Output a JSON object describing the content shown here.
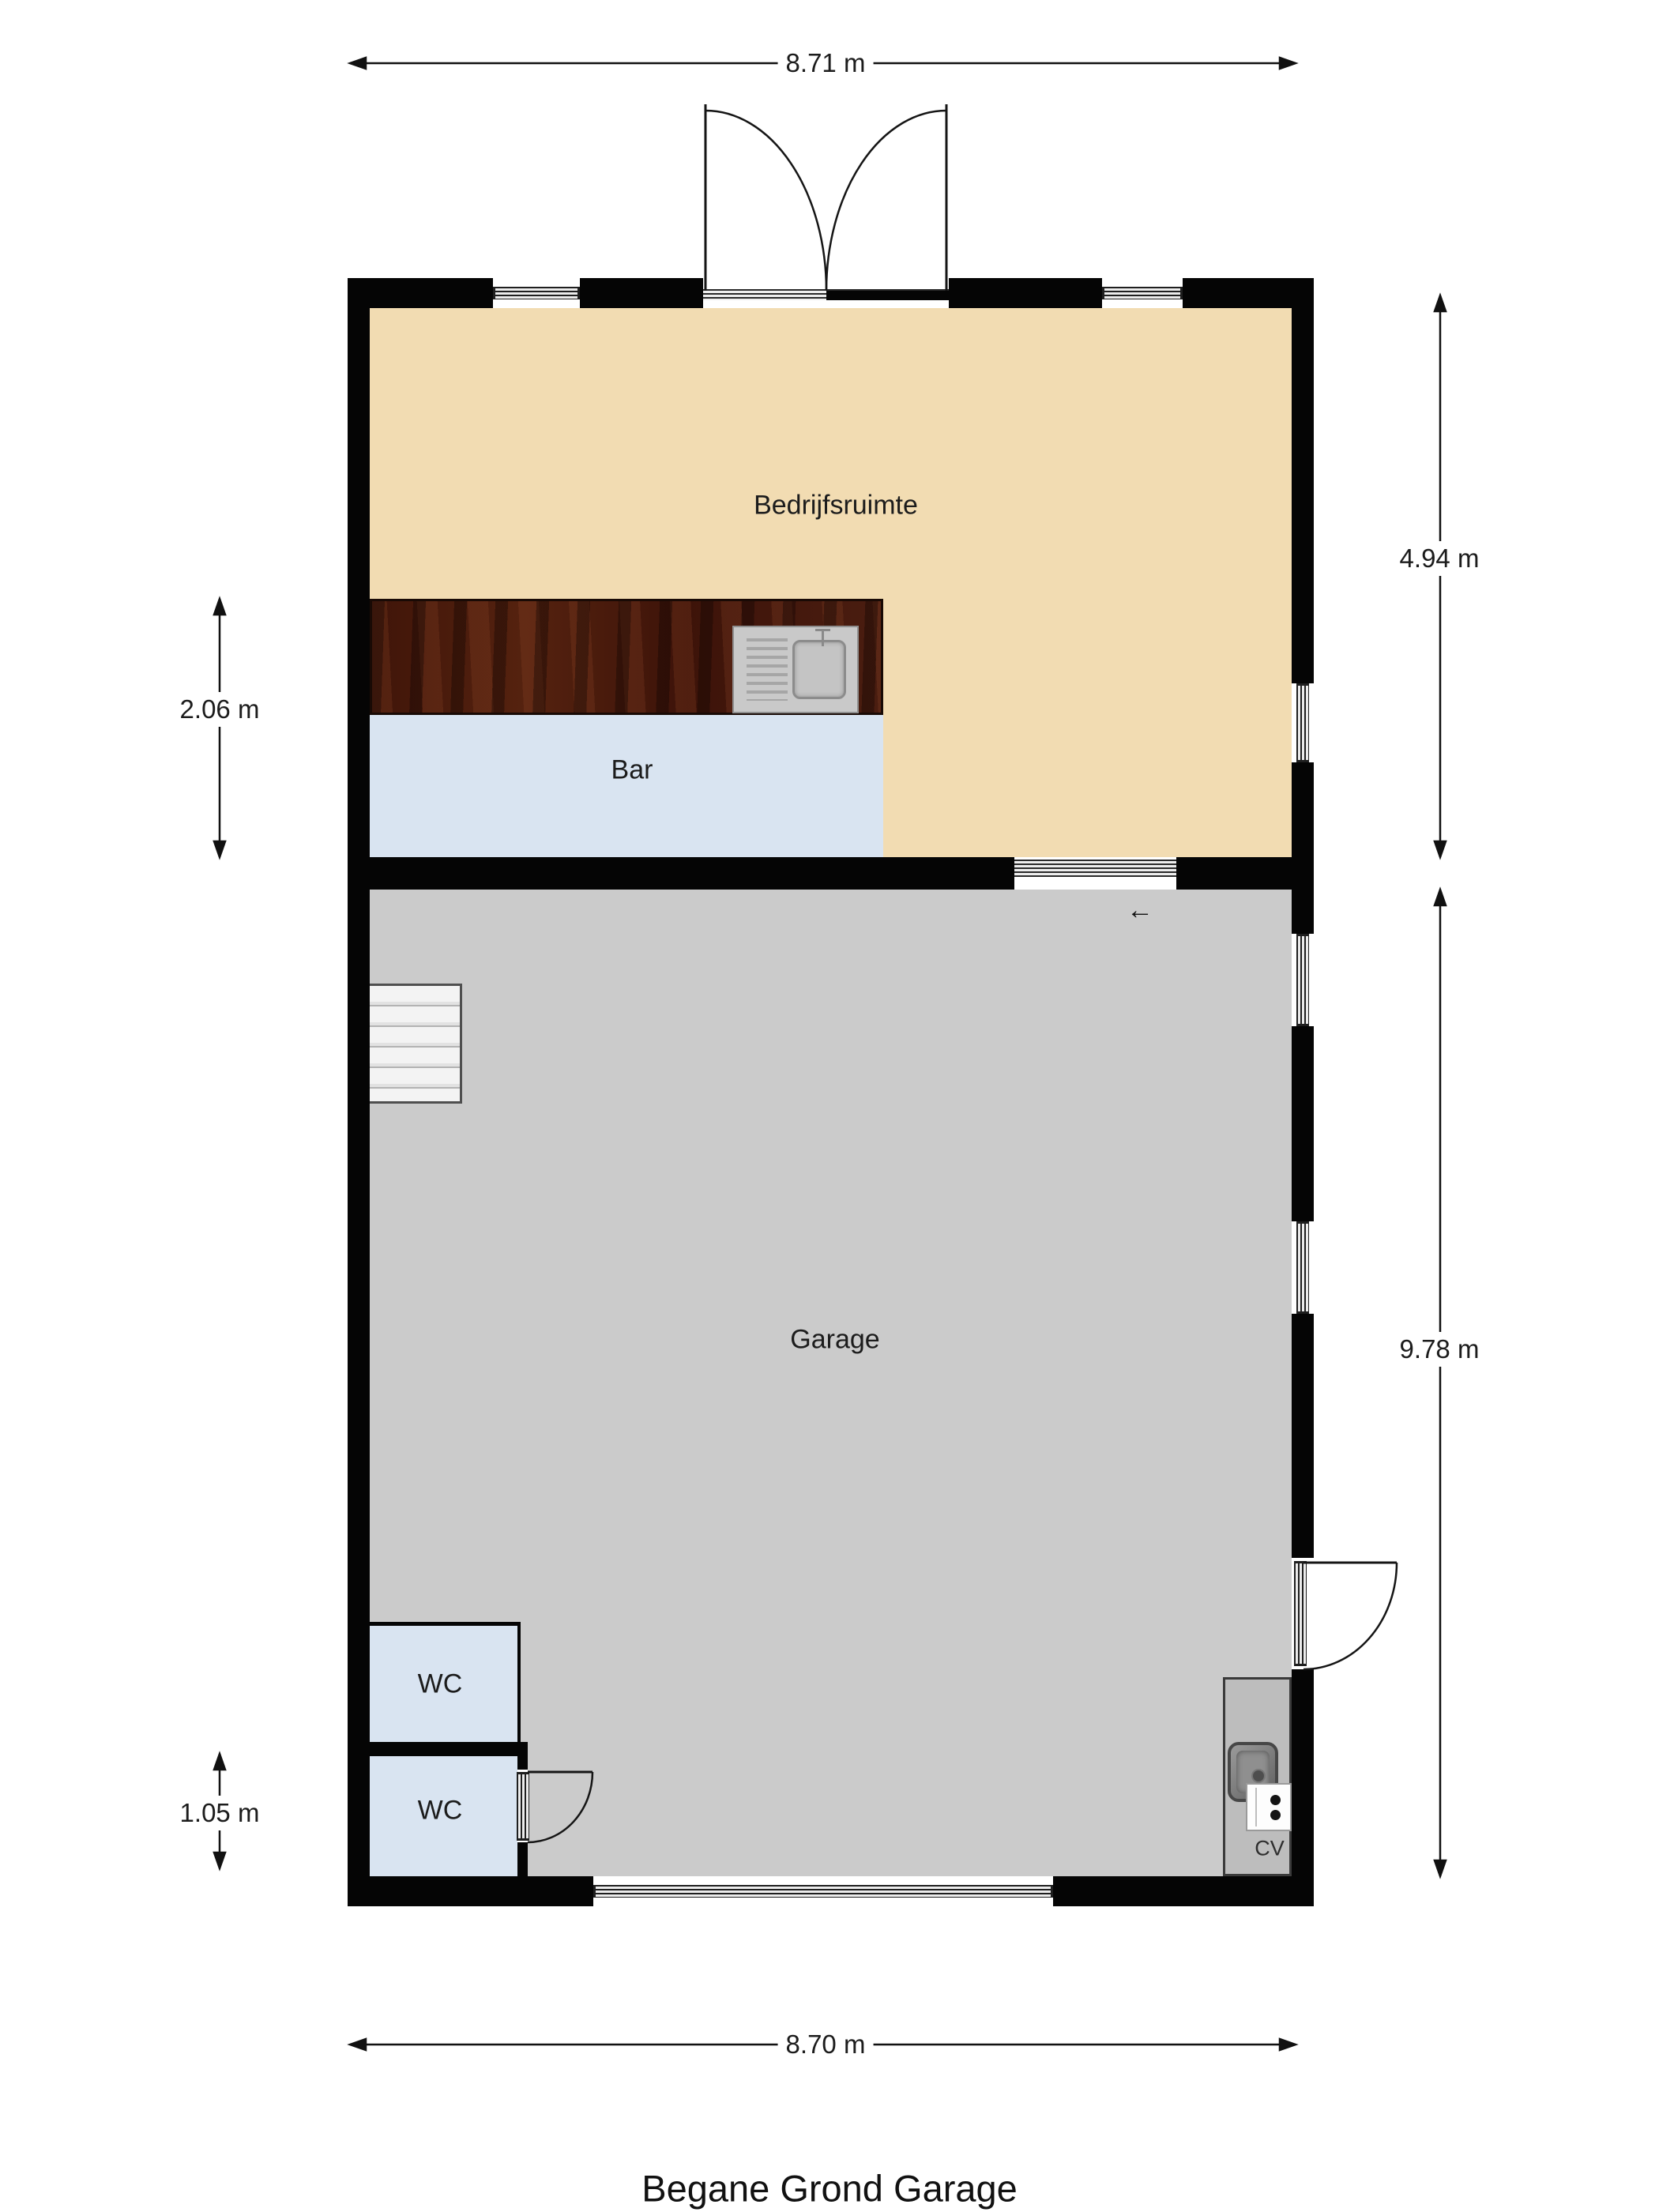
{
  "title": "Begane Grond Garage",
  "rooms": {
    "bedrijfsruimte": {
      "label": "Bedrijfsruimte"
    },
    "bar": {
      "label": "Bar"
    },
    "garage": {
      "label": "Garage"
    },
    "wc_upper": {
      "label": "WC"
    },
    "wc_lower": {
      "label": "WC"
    },
    "cv": {
      "label": "CV"
    }
  },
  "dimensions": {
    "top_width": "8.71 m",
    "bottom_width": "8.70 m",
    "right_upper_height": "4.94 m",
    "right_lower_height": "9.78 m",
    "left_bar_height": "2.06 m",
    "left_wc_height": "1.05 m"
  },
  "symbols": {
    "sliding_door_arrow": "←"
  },
  "colors": {
    "wall": "#050505",
    "bedrijfsruimte_floor": "#F2DCB2",
    "bar_floor": "#D9E4F1",
    "garage_floor": "#CBCBCB",
    "wc_floor": "#D9E4F1",
    "cv_floor": "#BDBDBD",
    "counter_wood": "#46190E",
    "stairs": "#EFEFEF",
    "page_background": "#FFFFFF"
  }
}
